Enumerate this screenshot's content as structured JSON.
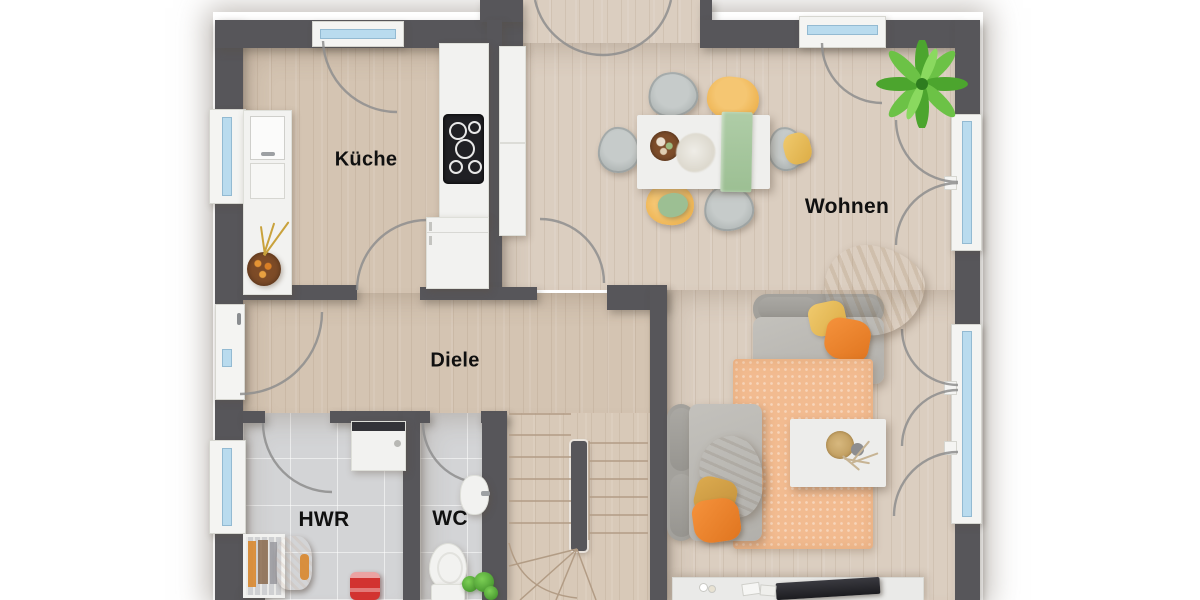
{
  "type": "floor_plan",
  "rooms": [
    {
      "id": "kueche",
      "label": "Küche"
    },
    {
      "id": "wohnen",
      "label": "Wohnen"
    },
    {
      "id": "diele",
      "label": "Diele"
    },
    {
      "id": "hwr",
      "label": "HWR"
    },
    {
      "id": "wc",
      "label": "WC"
    }
  ],
  "palette": {
    "wall": "#57565a",
    "wood": "#d4c4b2",
    "woodLight": "#dbcec0",
    "tile": "#d3d4d6",
    "frame": "#f4f4f2",
    "glass": "#b9dbee",
    "arc": "#8e8e8e",
    "rug": "#f2bb90",
    "accentOrange": "#ee8230",
    "accentYellow": "#eec45f",
    "runnerGreen": "#a9c9a0",
    "chairYellow": "#eeb452",
    "sofaGray": "#b8b6b1",
    "plantGreen": "#58b337"
  }
}
